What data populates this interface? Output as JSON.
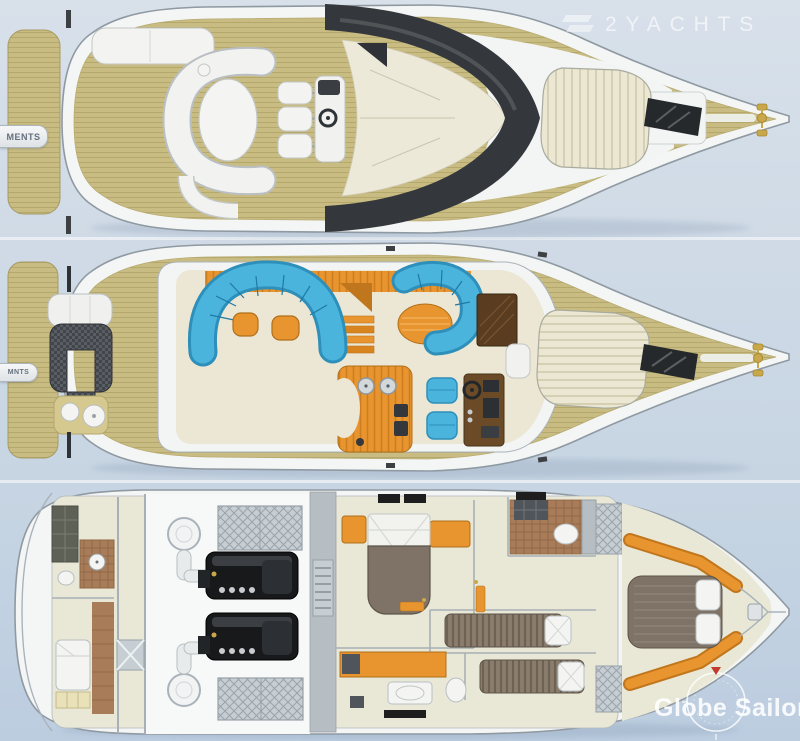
{
  "document": {
    "kind": "yacht-deck-plan",
    "views": 3
  },
  "watermarks": {
    "top": {
      "label": "2YACHTS",
      "icon": "double-wave-flag-icon"
    },
    "bottom": {
      "label": "Globe Sailor",
      "icon": "compass-circle-icon"
    }
  },
  "side_labels": {
    "flybridge": "MENTS",
    "main_deck": "MNTS"
  },
  "decks": [
    {
      "id": "flybridge-deck",
      "features": [
        "swim-platform",
        "aft-sunbed",
        "c-shaped-lounge",
        "cocktail-table",
        "triple-sun-loungers",
        "helm-station",
        "companion-seating",
        "windscreen-glass",
        "bow-sunpad",
        "foredeck-hatch",
        "anchor-windlass"
      ]
    },
    {
      "id": "main-deck",
      "features": [
        "swim-platform",
        "cockpit-u-sofa",
        "cockpit-table",
        "salon-c-sofa",
        "coffee-tables",
        "companionway-stairs",
        "dinette-sofa",
        "dinette-table",
        "tv-cabinet",
        "galley-sinks",
        "twin-helm-seats",
        "helm-console",
        "bow-sunpad",
        "foredeck-hatch",
        "anchor-windlass"
      ]
    },
    {
      "id": "lower-deck",
      "features": [
        "crew-cabin",
        "crew-bathroom",
        "engine-room",
        "twin-engines",
        "exhaust-mufflers",
        "deck-hatches",
        "staircase",
        "master-cabin",
        "master-bathroom",
        "guest-bathroom",
        "twin-single-beds",
        "vip-bow-cabin",
        "anchor-locker"
      ]
    }
  ],
  "palette": {
    "background_top": "#d8e1ea",
    "background_bottom": "#bccde0",
    "teak_deck": "#c9bc83",
    "teak_line": "#b5a86d",
    "hull_white": "#f4f6f6",
    "hull_outline": "#8f99a1",
    "sofa_blue": "#4ab4dc",
    "sofa_blue_dark": "#2d8fba",
    "wood_orange": "#e8952f",
    "wood_orange_dark": "#c0761c",
    "floor_cream": "#ebe7d4",
    "glass_dark": "#34383c",
    "engine_black": "#17191a",
    "hatch_gray": "#c6ced4",
    "bed_taupe": "#7e7366",
    "tile_brown": "#a87c58",
    "compass_red": "#c23b2e",
    "watermark_white": "#ffffff"
  }
}
